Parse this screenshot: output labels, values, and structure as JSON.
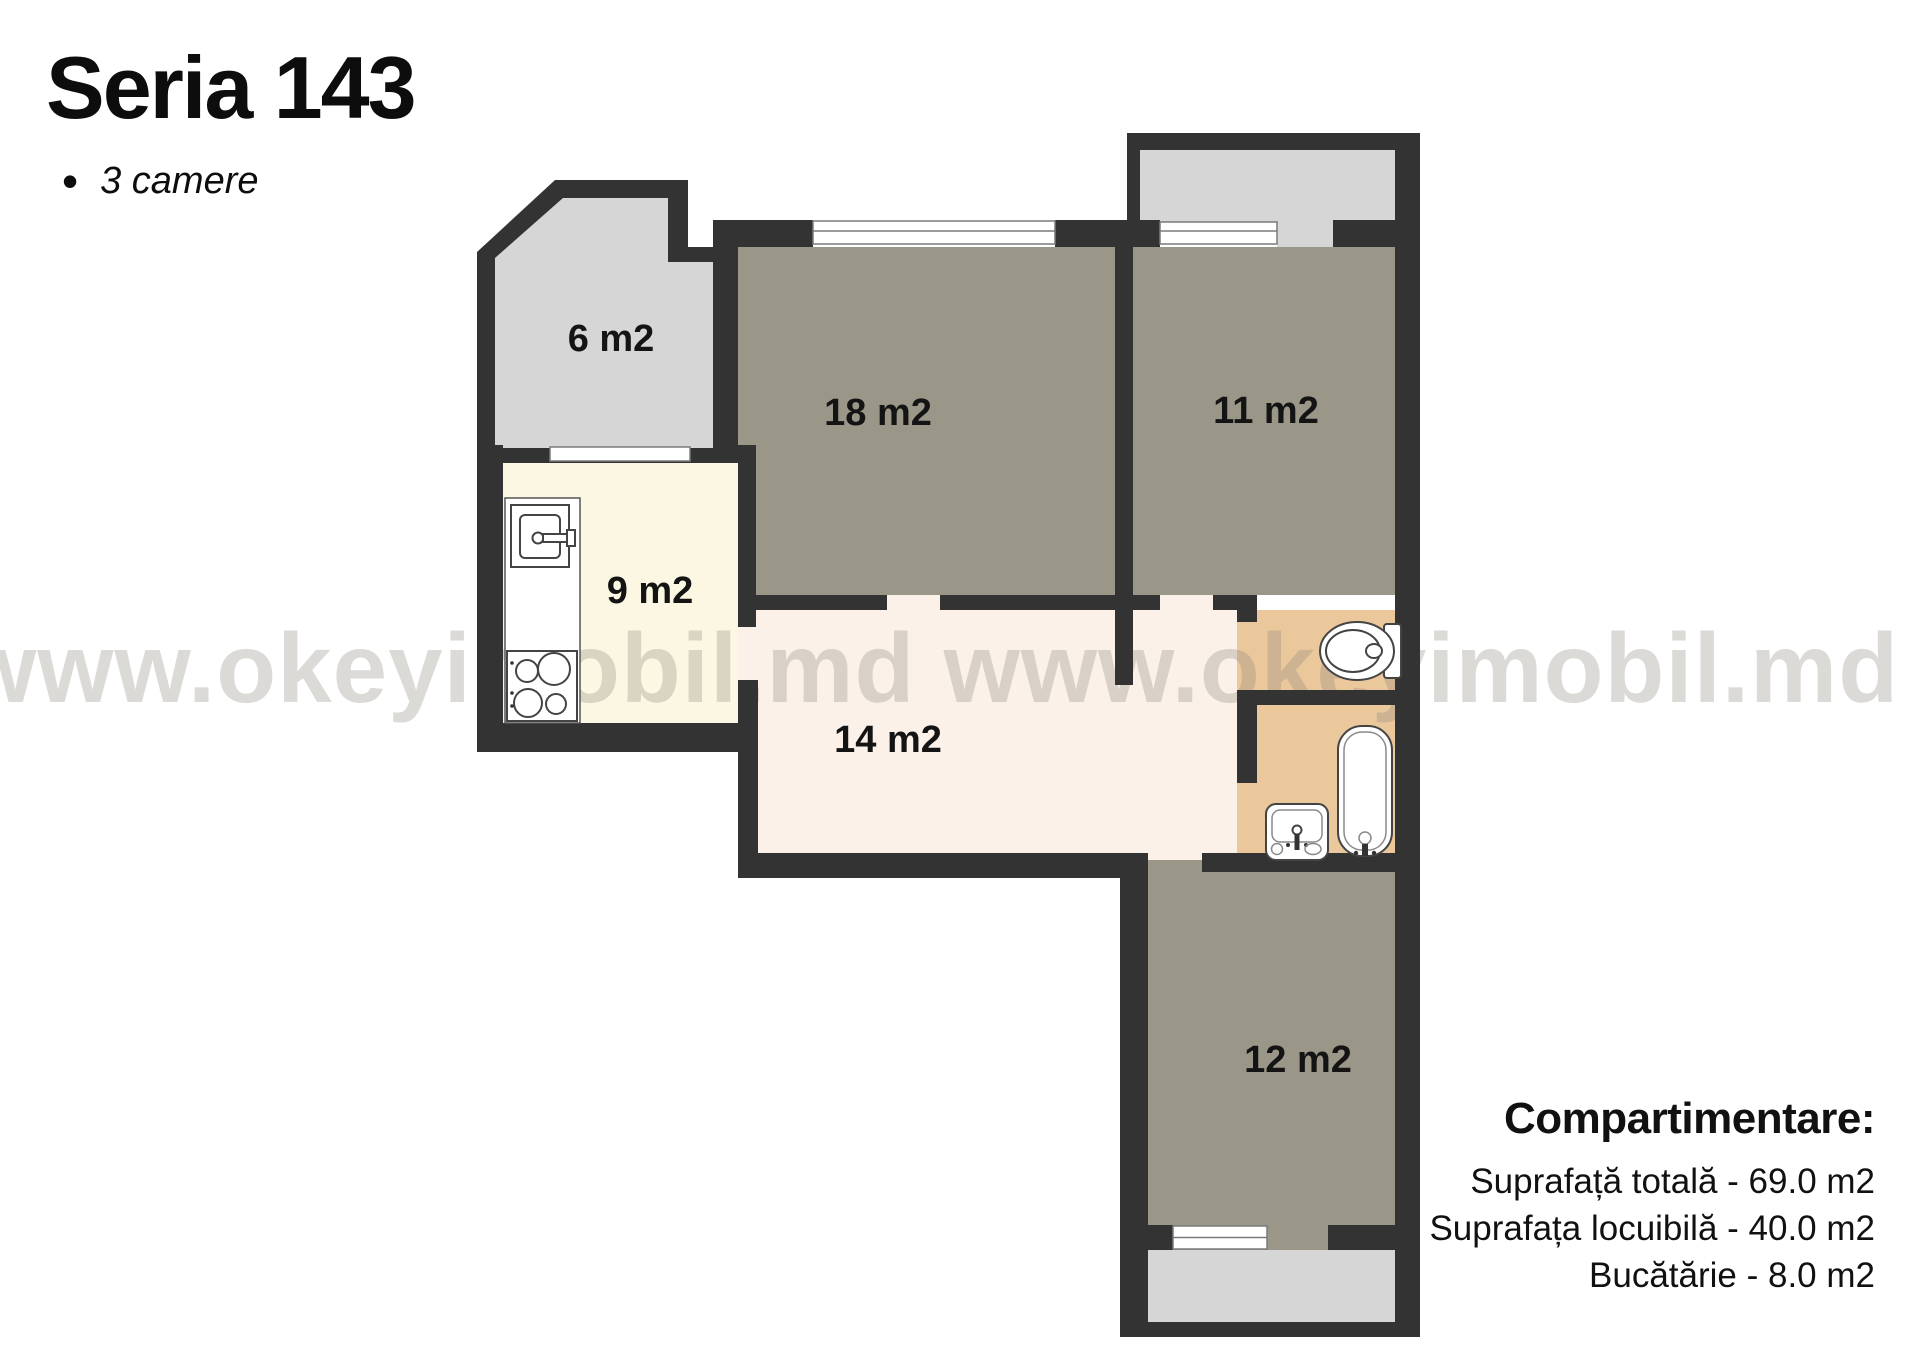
{
  "header": {
    "title": "Seria 143",
    "bullet": "•",
    "subtitle": "3 camere"
  },
  "watermark": {
    "text": "www.okeyimobil.md www.okeyimobil.md"
  },
  "rooms": {
    "balcony_top_left": {
      "label": "6 m2"
    },
    "living_room": {
      "label": "18 m2"
    },
    "bedroom_right": {
      "label": "11 m2"
    },
    "kitchen": {
      "label": "9 m2"
    },
    "hallway": {
      "label": "14 m2"
    },
    "bedroom_bottom": {
      "label": "12 m2"
    }
  },
  "legend": {
    "heading": "Compartimentare:",
    "lines": [
      "Suprafață totală - 69.0 m2",
      "Suprafața locuibilă - 40.0 m2",
      "Bucătărie - 8.0 m2"
    ]
  },
  "colors": {
    "wall": "#333333",
    "room": "#9b9788",
    "balcony": "#d6d6d6",
    "kitchen": "#fcf7e2",
    "hall": "#fbf1e8",
    "bath": "#eac89c",
    "watermark": "#8a867c"
  }
}
